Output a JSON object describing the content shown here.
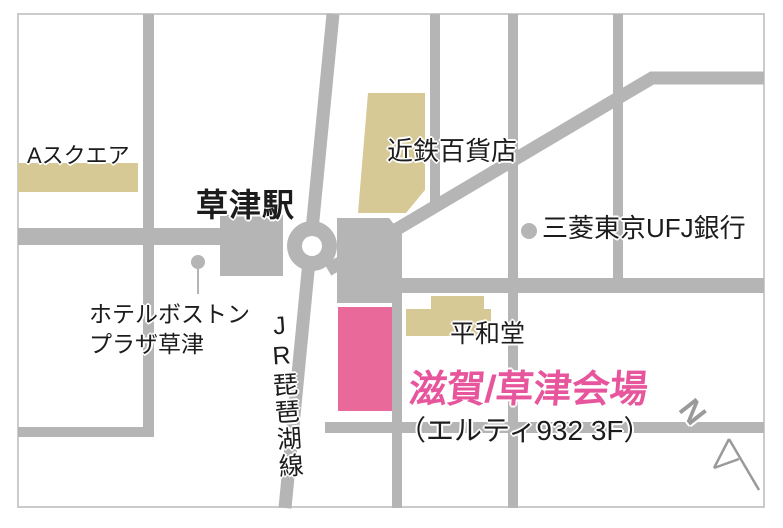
{
  "colors": {
    "road": "#b5b5b5",
    "building_gray": "#b5b5b5",
    "building_tan": "#d6c996",
    "venue_pink": "#e8699a",
    "venue_text_pink": "#e7569c",
    "label_text": "#1c1c1c",
    "north_gray": "#9a9a9a",
    "frame_border": "#cbcbcb",
    "white": "#ffffff"
  },
  "labels": {
    "a_square": "Aスクエア",
    "station": "草津駅",
    "kintetsu_dept_store": "近鉄百貨店",
    "bank": "三菱東京UFJ銀行",
    "hotel": "ホテルボストン\nプラザ草津",
    "jr_line": "JR琵琶湖線",
    "heiwado": "平和堂",
    "venue": "滋賀/草津会場",
    "venue_floor": "（エルティ932 3F）",
    "north": "N"
  }
}
